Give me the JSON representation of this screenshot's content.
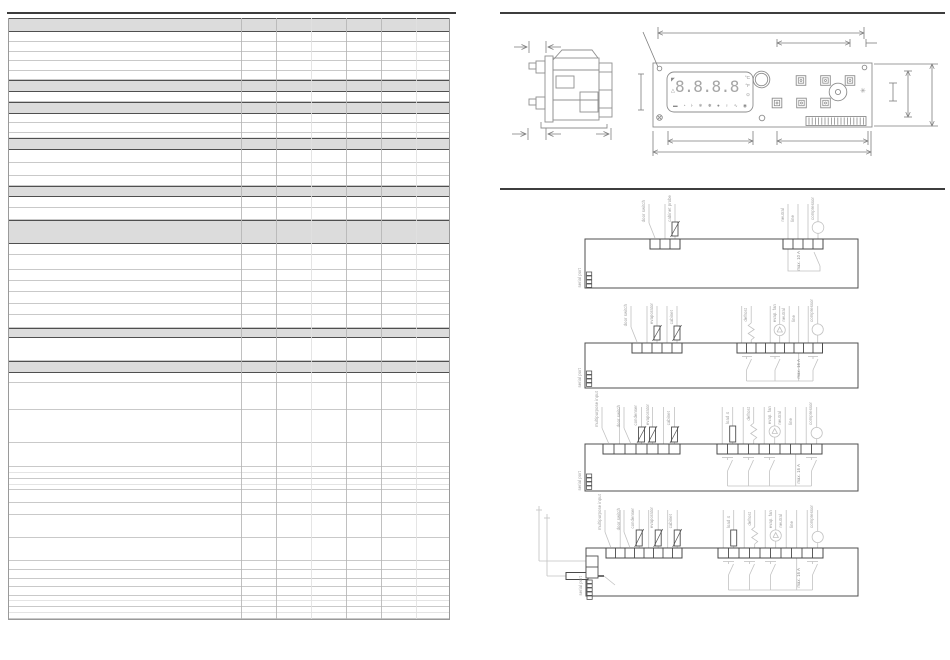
{
  "page": {
    "background": "#ffffff"
  },
  "drawing": {
    "display": {
      "digits": "8.8.8.8",
      "unit_c": "°C",
      "unit_f": "°F",
      "clock": "⊙",
      "defrost_mark": "◤",
      "alarm_mark": "△",
      "status_icons": [
        {
          "name": "setpoint-icon",
          "glyph": "▬"
        },
        {
          "name": "clock-icon",
          "glyph": "◔"
        },
        {
          "name": "aux-icon",
          "glyph": "⊦"
        },
        {
          "name": "defrost-icon",
          "glyph": "❄"
        },
        {
          "name": "fan-icon",
          "glyph": "❅"
        },
        {
          "name": "compressor-icon",
          "glyph": "●"
        },
        {
          "name": "light-icon",
          "glyph": "♀"
        },
        {
          "name": "energy-icon",
          "glyph": "∿"
        },
        {
          "name": "standby-icon",
          "glyph": "◉"
        }
      ]
    },
    "panel_snowflake": "✳"
  },
  "diagrams": [
    {
      "inputs": [
        "door switch",
        "cabinet probe"
      ],
      "outputs": [
        "neutral",
        "line",
        "compressor"
      ],
      "fuse": "max. 10 A",
      "serial": "serial port"
    },
    {
      "inputs": [
        "door switch",
        "evaporator",
        "cabinet"
      ],
      "outputs": [
        "defrost",
        "evap. fan",
        "neutral",
        "line",
        "compressor"
      ],
      "fuse": "max. 16 A",
      "serial": "serial port"
    },
    {
      "inputs": [
        "multipurpose input",
        "door switch",
        "condenser",
        "evaporator",
        "cabinet"
      ],
      "outputs": [
        "load 4",
        "defrost",
        "evap. fan",
        "neutral",
        "line",
        "compressor"
      ],
      "fuse": "max. 16 A",
      "serial": "serial port"
    },
    {
      "inputs": [
        "multipurpose input",
        "door switch",
        "condenser",
        "evaporator",
        "cabinet"
      ],
      "outputs": [
        "load 4",
        "defrost",
        "evap. fan",
        "neutral",
        "line",
        "compressor"
      ],
      "fuse": "max. 16 A",
      "serial": "serial port"
    }
  ],
  "table": {
    "rows": [
      {
        "type": "section",
        "h": 14
      },
      {
        "type": "row",
        "h": 10
      },
      {
        "type": "row",
        "h": 10
      },
      {
        "type": "row",
        "h": 9
      },
      {
        "type": "row",
        "h": 10
      },
      {
        "type": "row",
        "h": 9
      },
      {
        "type": "section",
        "h": 12
      },
      {
        "type": "row",
        "h": 10
      },
      {
        "type": "section",
        "h": 12
      },
      {
        "type": "row",
        "h": 9
      },
      {
        "type": "row",
        "h": 10
      },
      {
        "type": "row",
        "h": 5,
        "light": true
      },
      {
        "type": "section",
        "h": 12
      },
      {
        "type": "row",
        "h": 13
      },
      {
        "type": "row",
        "h": 13
      },
      {
        "type": "row",
        "h": 10
      },
      {
        "type": "section",
        "h": 11
      },
      {
        "type": "row",
        "h": 11
      },
      {
        "type": "row",
        "h": 12
      },
      {
        "type": "section",
        "h": 24
      },
      {
        "type": "row",
        "h": 11
      },
      {
        "type": "row",
        "h": 15
      },
      {
        "type": "row",
        "h": 11
      },
      {
        "type": "row",
        "h": 11
      },
      {
        "type": "row",
        "h": 12
      },
      {
        "type": "row",
        "h": 11
      },
      {
        "type": "row",
        "h": 13
      },
      {
        "type": "section",
        "h": 10
      },
      {
        "type": "row",
        "h": 23
      },
      {
        "type": "section",
        "h": 12
      },
      {
        "type": "row",
        "h": 10
      },
      {
        "type": "row",
        "h": 27
      },
      {
        "type": "row",
        "h": 33
      },
      {
        "type": "row",
        "h": 24
      },
      {
        "type": "row",
        "h": 6,
        "light": true
      },
      {
        "type": "row",
        "h": 6
      },
      {
        "type": "row",
        "h": 6,
        "light": true
      },
      {
        "type": "row",
        "h": 5
      },
      {
        "type": "row",
        "h": 13
      },
      {
        "type": "row",
        "h": 12
      },
      {
        "type": "row",
        "h": 23
      },
      {
        "type": "row",
        "h": 23
      },
      {
        "type": "row",
        "h": 9
      },
      {
        "type": "row",
        "h": 9
      },
      {
        "type": "row",
        "h": 8
      },
      {
        "type": "row",
        "h": 9
      },
      {
        "type": "row",
        "h": 5,
        "light": true
      },
      {
        "type": "row",
        "h": 6
      },
      {
        "type": "row",
        "h": 6,
        "light": true
      },
      {
        "type": "row",
        "h": 6
      }
    ]
  },
  "colors": {
    "rule": "#3d3d3d",
    "section_bg": "#dcdcdc",
    "section_border": "#4f4f4f",
    "grid": "#c9c9c9",
    "grid_light": "#e4e4e4",
    "column": "#b5b5b5",
    "column_light": "#e0e0e0",
    "drawing_stroke": "#8d8d8d",
    "wire": "#c2c2c2",
    "symbol_dark": "#4f4f4f",
    "label": "#9a9a9a"
  }
}
